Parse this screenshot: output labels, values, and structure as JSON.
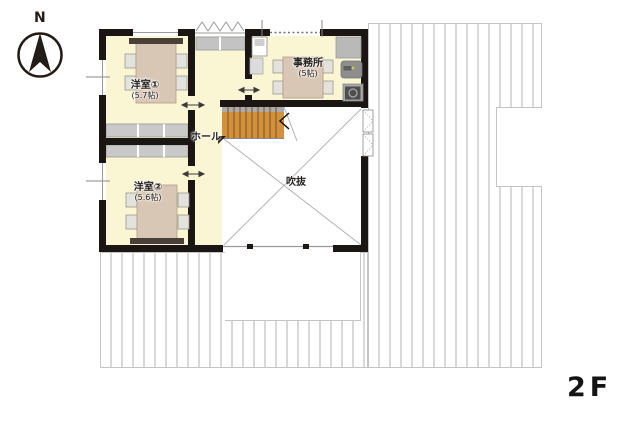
{
  "floor_label": "2F",
  "compass": {
    "label": "N"
  },
  "rooms": {
    "western1": {
      "name": "洋室①",
      "size": "(5.7帖)"
    },
    "western2": {
      "name": "洋室②",
      "size": "(5.6帖)"
    },
    "office": {
      "name": "事務所",
      "size": "(5帖)"
    },
    "hall": {
      "name": "ホール"
    },
    "void": {
      "name": "吹抜"
    }
  },
  "colors": {
    "room_fill": "#faf5d2",
    "wall": "#1b1613",
    "closet": "#c9c9c9",
    "stairs": "#d2913c",
    "table": "#d9c7b6",
    "roof_stripe": "#d9d9d9"
  }
}
